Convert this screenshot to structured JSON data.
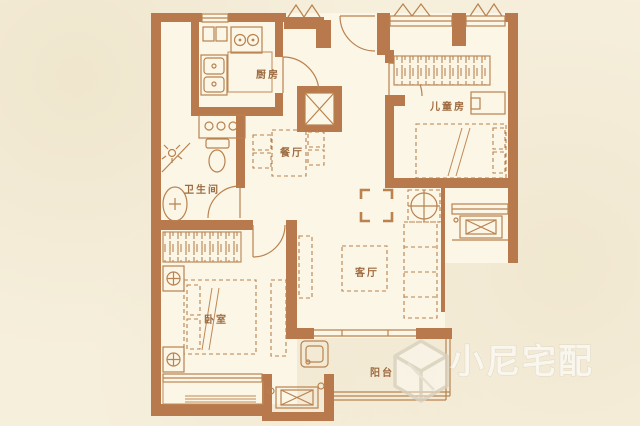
{
  "plan": {
    "type": "apartment-floor-plan",
    "rooms": [
      {
        "id": "kitchen",
        "label": "厨房"
      },
      {
        "id": "children",
        "label": "儿童房"
      },
      {
        "id": "dining",
        "label": "餐厅"
      },
      {
        "id": "bathroom",
        "label": "卫生间"
      },
      {
        "id": "living",
        "label": "客厅"
      },
      {
        "id": "bedroom",
        "label": "卧室"
      },
      {
        "id": "balcony",
        "label": "阳台"
      }
    ],
    "watermark": {
      "text": "小尼宅配"
    },
    "colors": {
      "background": "#f6efdc",
      "floor": "#fbf6e6",
      "wall": "#b87a4c",
      "line": "#b9824f",
      "label": "#9d6b41",
      "watermark_fill": "#ffffff",
      "watermark_outline": "#d6cfbd"
    }
  }
}
